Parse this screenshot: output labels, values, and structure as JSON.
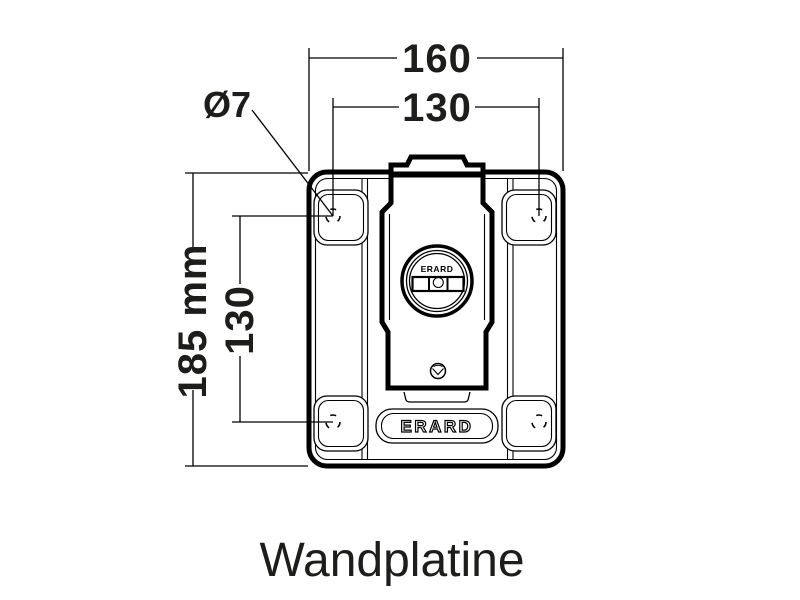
{
  "drawing": {
    "caption": "Wandplatine",
    "dimensions": {
      "outer_width": "160",
      "hole_spacing_width": "130",
      "outer_height": "185 mm",
      "hole_spacing_height": "130",
      "hole_diameter": "Ø7"
    },
    "brand": {
      "badge": "ERARD",
      "level": "ERARD"
    },
    "colors": {
      "line": "#000000",
      "text": "#1d1d1b",
      "background": "#ffffff"
    }
  }
}
